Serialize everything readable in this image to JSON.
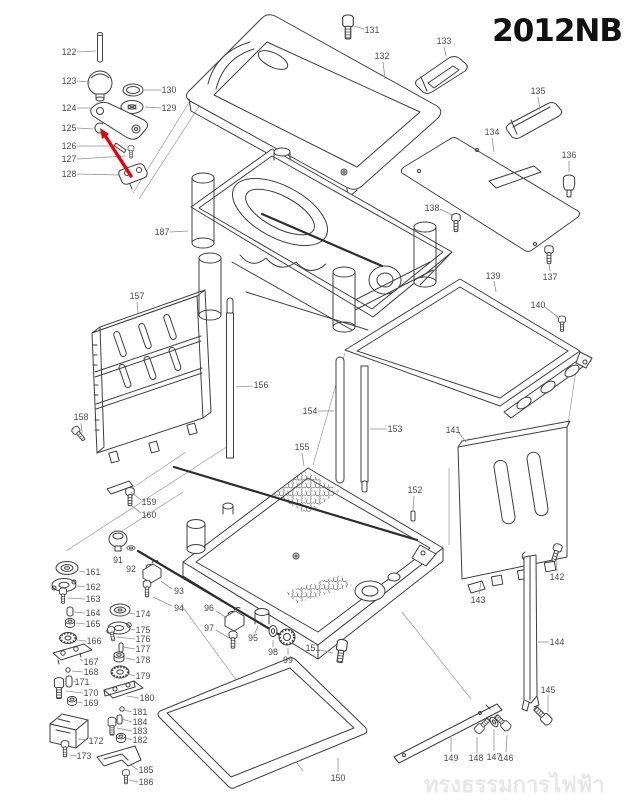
{
  "title": "2012NB",
  "watermark": "ทรงธรรมการไฟฟ้า",
  "diagram_type": "exploded-parts-diagram",
  "colors": {
    "line": "#3f3f3f",
    "label": "#4a4a4a",
    "leader": "#8f8f8f",
    "arrow": "#e3000e",
    "title": "#111111",
    "watermark": "#e7e7e7",
    "background": "#ffffff"
  },
  "arrow": {
    "line": [
      131,
      176,
      106,
      137
    ],
    "head": [
      100,
      128,
      109,
      134,
      102,
      139
    ]
  },
  "labels": [
    {
      "t": "122",
      "x": 69,
      "y": 52,
      "lead": [
        77,
        52,
        96,
        51
      ]
    },
    {
      "t": "123",
      "x": 69,
      "y": 81,
      "lead": [
        77,
        81,
        90,
        82
      ]
    },
    {
      "t": "130",
      "x": 169,
      "y": 90,
      "lead": [
        161,
        90,
        144,
        90
      ]
    },
    {
      "t": "129",
      "x": 169,
      "y": 108,
      "lead": [
        161,
        108,
        145,
        107
      ]
    },
    {
      "t": "124",
      "x": 69,
      "y": 108,
      "lead": [
        77,
        108,
        92,
        108
      ]
    },
    {
      "t": "125",
      "x": 69,
      "y": 128,
      "lead": [
        77,
        128,
        93,
        129
      ]
    },
    {
      "t": "126",
      "x": 69,
      "y": 146,
      "lead": [
        77,
        146,
        114,
        146
      ]
    },
    {
      "t": "127",
      "x": 69,
      "y": 159,
      "lead": [
        77,
        159,
        125,
        156
      ]
    },
    {
      "t": "128",
      "x": 69,
      "y": 174,
      "lead": [
        77,
        174,
        119,
        175
      ]
    },
    {
      "t": "131",
      "x": 372,
      "y": 30,
      "lead": [
        364,
        29,
        354,
        26
      ]
    },
    {
      "t": "132",
      "x": 382,
      "y": 56,
      "lead": [
        383,
        62,
        385,
        79
      ]
    },
    {
      "t": "133",
      "x": 444,
      "y": 41,
      "lead": [
        444,
        47,
        446,
        56
      ]
    },
    {
      "t": "134",
      "x": 492,
      "y": 132,
      "lead": [
        492,
        138,
        494,
        152
      ]
    },
    {
      "t": "135",
      "x": 538,
      "y": 91,
      "lead": [
        538,
        97,
        540,
        110
      ]
    },
    {
      "t": "136",
      "x": 569,
      "y": 155,
      "lead": [
        569,
        161,
        569,
        172
      ]
    },
    {
      "t": "137",
      "x": 550,
      "y": 277,
      "lead": [
        550,
        271,
        549,
        263
      ]
    },
    {
      "t": "138",
      "x": 432,
      "y": 208,
      "lead": [
        440,
        209,
        452,
        215
      ]
    },
    {
      "t": "139",
      "x": 493,
      "y": 276,
      "lead": [
        494,
        281,
        496,
        292
      ]
    },
    {
      "t": "140",
      "x": 538,
      "y": 305,
      "lead": [
        545,
        307,
        559,
        318
      ]
    },
    {
      "t": "187",
      "x": 162,
      "y": 232,
      "lead": [
        170,
        232,
        188,
        231
      ]
    },
    {
      "t": "157",
      "x": 137,
      "y": 296,
      "lead": [
        137,
        302,
        138,
        313
      ]
    },
    {
      "t": "156",
      "x": 261,
      "y": 385,
      "lead": [
        253,
        386,
        236,
        387
      ]
    },
    {
      "t": "154",
      "x": 310,
      "y": 411,
      "lead": [
        318,
        411,
        334,
        411
      ]
    },
    {
      "t": "153",
      "x": 395,
      "y": 429,
      "lead": [
        387,
        429,
        370,
        429
      ]
    },
    {
      "t": "155",
      "x": 302,
      "y": 447,
      "lead": [
        302,
        453,
        304,
        466
      ]
    },
    {
      "t": "158",
      "x": 81,
      "y": 417,
      "lead": [
        81,
        423,
        82,
        433
      ]
    },
    {
      "t": "159",
      "x": 149,
      "y": 502,
      "lead": [
        141,
        500,
        131,
        492
      ]
    },
    {
      "t": "160",
      "x": 149,
      "y": 515,
      "lead": [
        141,
        513,
        132,
        506
      ]
    },
    {
      "t": "141",
      "x": 453,
      "y": 430,
      "lead": [
        459,
        433,
        466,
        442
      ]
    },
    {
      "t": "152",
      "x": 415,
      "y": 490,
      "lead": [
        414,
        496,
        413,
        510
      ]
    },
    {
      "t": "142",
      "x": 557,
      "y": 577,
      "lead": [
        557,
        571,
        556,
        560
      ]
    },
    {
      "t": "143",
      "x": 478,
      "y": 600,
      "lead": [
        479,
        594,
        481,
        582
      ]
    },
    {
      "t": "144",
      "x": 557,
      "y": 642,
      "lead": [
        549,
        642,
        538,
        642
      ]
    },
    {
      "t": "145",
      "x": 548,
      "y": 690,
      "lead": [
        548,
        695,
        548,
        712
      ]
    },
    {
      "t": "146",
      "x": 506,
      "y": 758,
      "lead": [
        506,
        752,
        507,
        735
      ]
    },
    {
      "t": "147",
      "x": 494,
      "y": 757,
      "lead": [
        494,
        751,
        494,
        729
      ]
    },
    {
      "t": "148",
      "x": 476,
      "y": 758,
      "lead": [
        477,
        753,
        477,
        737
      ]
    },
    {
      "t": "149",
      "x": 451,
      "y": 758,
      "lead": [
        451,
        752,
        451,
        736
      ]
    },
    {
      "t": "150",
      "x": 338,
      "y": 778,
      "lead": [
        338,
        772,
        338,
        758
      ]
    },
    {
      "t": "151",
      "x": 313,
      "y": 648,
      "lead": [
        320,
        650,
        333,
        653
      ]
    },
    {
      "t": "91",
      "x": 118,
      "y": 560
    },
    {
      "t": "92",
      "x": 131,
      "y": 569
    },
    {
      "t": "93",
      "x": 179,
      "y": 591,
      "lead": [
        172,
        589,
        161,
        581
      ]
    },
    {
      "t": "94",
      "x": 179,
      "y": 608,
      "lead": [
        172,
        606,
        153,
        597
      ]
    },
    {
      "t": "96",
      "x": 209,
      "y": 608,
      "lead": [
        216,
        611,
        227,
        618
      ]
    },
    {
      "t": "97",
      "x": 209,
      "y": 628,
      "lead": [
        216,
        630,
        229,
        638
      ]
    },
    {
      "t": "95",
      "x": 253,
      "y": 638,
      "lead": [
        255,
        633,
        258,
        626
      ]
    },
    {
      "t": "98",
      "x": 273,
      "y": 652,
      "lead": [
        273,
        647,
        273,
        640
      ]
    },
    {
      "t": "99",
      "x": 288,
      "y": 660,
      "lead": [
        288,
        655,
        288,
        648
      ]
    },
    {
      "t": "161",
      "x": 93,
      "y": 572,
      "lead": [
        85,
        572,
        79,
        571
      ]
    },
    {
      "t": "162",
      "x": 93,
      "y": 587,
      "lead": [
        85,
        587,
        77,
        586
      ]
    },
    {
      "t": "163",
      "x": 93,
      "y": 599,
      "lead": [
        85,
        599,
        68,
        598
      ]
    },
    {
      "t": "164",
      "x": 93,
      "y": 613,
      "lead": [
        85,
        613,
        74,
        612
      ]
    },
    {
      "t": "165",
      "x": 93,
      "y": 624,
      "lead": [
        85,
        624,
        76,
        623
      ]
    },
    {
      "t": "166",
      "x": 94,
      "y": 641,
      "lead": [
        86,
        641,
        77,
        640
      ]
    },
    {
      "t": "167",
      "x": 91,
      "y": 662,
      "lead": [
        83,
        661,
        80,
        659
      ]
    },
    {
      "t": "168",
      "x": 91,
      "y": 672,
      "lead": [
        83,
        672,
        72,
        671
      ]
    },
    {
      "t": "171",
      "x": 82,
      "y": 682,
      "lead": [
        76,
        682,
        73,
        681
      ]
    },
    {
      "t": "170",
      "x": 91,
      "y": 693,
      "lead": [
        83,
        693,
        66,
        691
      ]
    },
    {
      "t": "169",
      "x": 91,
      "y": 703,
      "lead": [
        83,
        703,
        76,
        702
      ]
    },
    {
      "t": "172",
      "x": 96,
      "y": 741,
      "lead": [
        88,
        740,
        78,
        739
      ]
    },
    {
      "t": "173",
      "x": 84,
      "y": 756,
      "lead": [
        77,
        756,
        70,
        755
      ]
    },
    {
      "t": "174",
      "x": 143,
      "y": 614,
      "lead": [
        135,
        614,
        128,
        613
      ]
    },
    {
      "t": "175",
      "x": 143,
      "y": 630,
      "lead": [
        135,
        630,
        130,
        629
      ]
    },
    {
      "t": "176",
      "x": 143,
      "y": 639,
      "lead": [
        135,
        639,
        116,
        637
      ]
    },
    {
      "t": "177",
      "x": 143,
      "y": 649,
      "lead": [
        135,
        649,
        123,
        647
      ]
    },
    {
      "t": "178",
      "x": 143,
      "y": 660,
      "lead": [
        135,
        660,
        126,
        658
      ]
    },
    {
      "t": "179",
      "x": 143,
      "y": 676,
      "lead": [
        135,
        676,
        128,
        674
      ]
    },
    {
      "t": "180",
      "x": 147,
      "y": 698,
      "lead": [
        139,
        698,
        127,
        696
      ]
    },
    {
      "t": "181",
      "x": 140,
      "y": 712,
      "lead": [
        132,
        712,
        124,
        710
      ]
    },
    {
      "t": "184",
      "x": 140,
      "y": 722,
      "lead": [
        132,
        722,
        122,
        719
      ]
    },
    {
      "t": "183",
      "x": 140,
      "y": 731,
      "lead": [
        132,
        731,
        117,
        728
      ]
    },
    {
      "t": "182",
      "x": 140,
      "y": 740,
      "lead": [
        132,
        740,
        126,
        738
      ]
    },
    {
      "t": "185",
      "x": 146,
      "y": 770,
      "lead": [
        138,
        770,
        131,
        765
      ]
    },
    {
      "t": "186",
      "x": 146,
      "y": 782,
      "lead": [
        138,
        782,
        129,
        780
      ]
    }
  ]
}
